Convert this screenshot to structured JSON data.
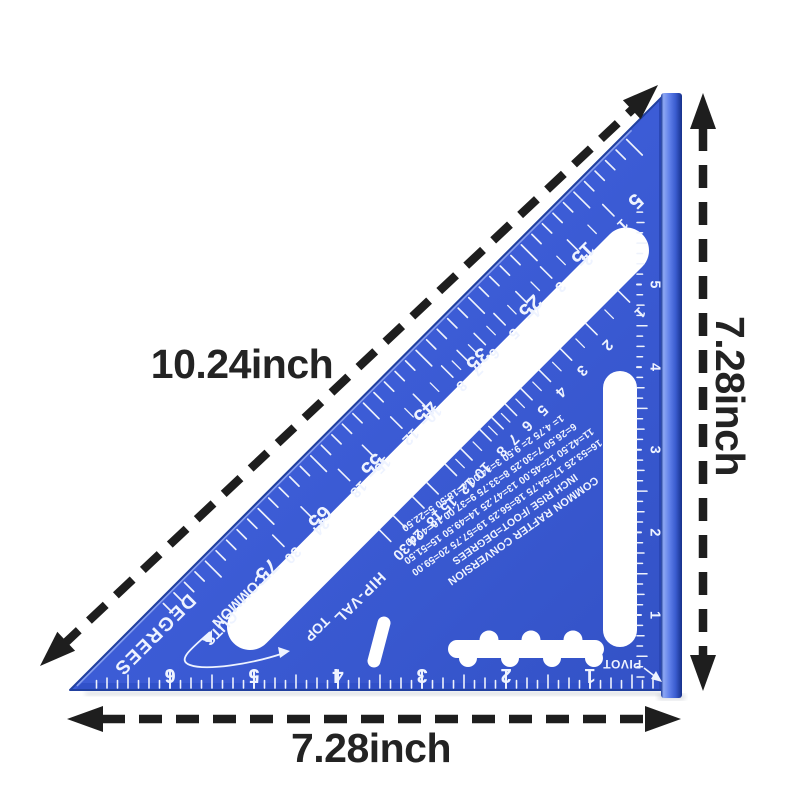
{
  "product": {
    "dimension_labels": {
      "hypotenuse": "10.24inch",
      "right": "7.28inch",
      "bottom": "7.28inch"
    },
    "square": {
      "face_color": "#3c5cd6",
      "marking_color": "#eef3ff",
      "degree_scale": {
        "label": "DEGREES",
        "values": [
          5,
          15,
          25,
          35,
          45,
          55,
          65,
          75
        ]
      },
      "common_scale": {
        "label_top": "COMMON",
        "label_bottom": "CUTS",
        "pointer_label": "TOP",
        "values": [
          1,
          2,
          3,
          4,
          5,
          6,
          7,
          8,
          10,
          12,
          15,
          18,
          24,
          30
        ]
      },
      "hip_scale": {
        "label": "HIP-VAL",
        "values": [
          1,
          2,
          3,
          4,
          5,
          6,
          7,
          8,
          10,
          12,
          15,
          18,
          24,
          30
        ]
      },
      "right_inch_scale": {
        "values": [
          1,
          2,
          3,
          4,
          5
        ]
      },
      "bottom_inch_scale": {
        "values": [
          1,
          2,
          3,
          4,
          5,
          6
        ]
      },
      "pivot_label": "PIVOT",
      "conversion_table": {
        "lines": [
          "COMMON RAFTER CONVERSION",
          "INCH RISE /FOOT=DEGREES",
          "16=53.25 17=54.75 18=56.25 19=57.75 20=59.00",
          "11=42.50 12=45.00 13=47.25 14=49.50 15=51.50",
          "6=26.50 7=30.25 8=33.75 9=37.00 10=40.00",
          "1= 4.75 2= 9.50 3=14.00 4=18.50 5=22.50"
        ]
      }
    }
  }
}
